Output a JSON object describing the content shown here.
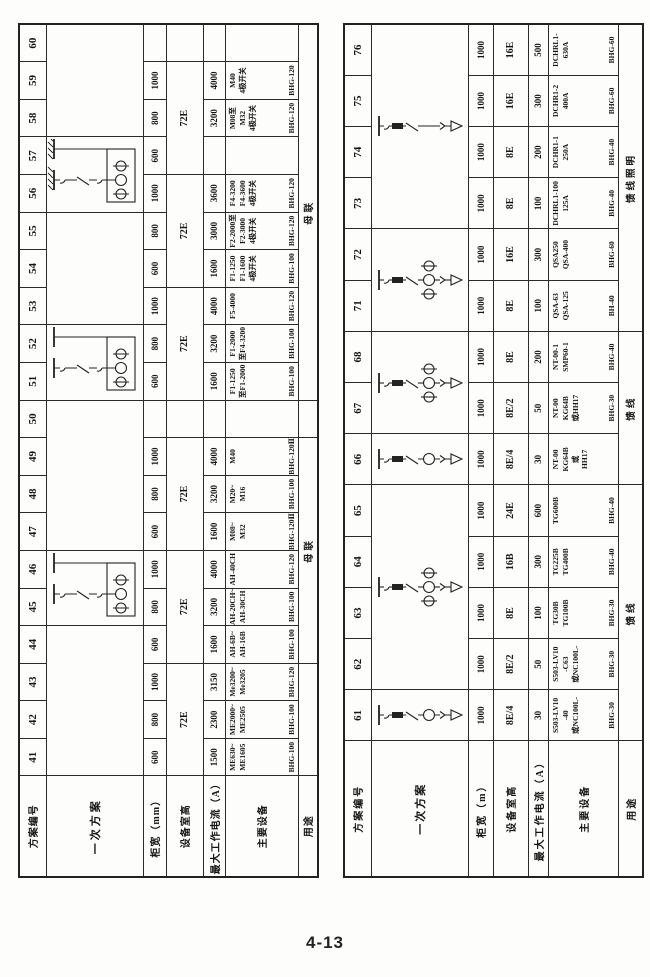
{
  "page": {
    "number": "4-13"
  },
  "left_table": {
    "header_labels": [
      "方案编号",
      "一次方案",
      "柜宽（mm）",
      "设备室高",
      "最大工作电流（A）",
      "主要设备",
      "用途"
    ],
    "column_numbers": [
      "41",
      "42",
      "43",
      "44",
      "45",
      "46",
      "47",
      "48",
      "49",
      "50",
      "51",
      "52",
      "53",
      "54",
      "55",
      "56",
      "57",
      "58",
      "59",
      "60"
    ],
    "diagram_cells": [
      {
        "span": 4,
        "type": ""
      },
      {
        "span": 2,
        "type": "bus-tie"
      },
      {
        "span": 4,
        "type": ""
      },
      {
        "span": 2,
        "type": "bus-tie"
      },
      {
        "span": 3,
        "type": ""
      },
      {
        "span": 2,
        "type": "bus-tie-earthed"
      },
      {
        "span": 3,
        "type": ""
      }
    ],
    "cabinet_width": [
      "600",
      "800",
      "1000",
      "600",
      "800",
      "1000",
      "600",
      "800",
      "1000",
      "",
      "600",
      "800",
      "1000",
      "600",
      "800",
      "1000",
      "600",
      "800",
      "1000",
      ""
    ],
    "room_height_cells": [
      {
        "span": 3,
        "text": "72E"
      },
      {
        "span": 3,
        "text": "72E"
      },
      {
        "span": 3,
        "text": "72E"
      },
      {
        "span": 1,
        "text": ""
      },
      {
        "span": 3,
        "text": "72E"
      },
      {
        "span": 3,
        "text": "72E"
      },
      {
        "span": 3,
        "text": "72E"
      },
      {
        "span": 1,
        "text": ""
      }
    ],
    "max_current": [
      "1500",
      "2300",
      "3150",
      "1600",
      "3200",
      "4000",
      "1600",
      "3200",
      "4000",
      "",
      "1600",
      "3200",
      "4000",
      "1600",
      "3000",
      "3600",
      "",
      "3200",
      "4000",
      ""
    ],
    "equipment": [
      {
        "lines": [
          "ME630~",
          "ME1605"
        ],
        "model": "BHG-100"
      },
      {
        "lines": [
          "ME2000~",
          "ME2505"
        ],
        "model": "BHG-100"
      },
      {
        "lines": [
          "Me3200~",
          "Me3205"
        ],
        "model": "BHG-120"
      },
      {
        "lines": [
          "AH-6B~",
          "AH-16B"
        ],
        "model": "BHG-100"
      },
      {
        "lines": [
          "AH-20CH~",
          "AH-30CH"
        ],
        "model": "BHG-100"
      },
      {
        "lines": [
          "AH-40CH"
        ],
        "model": "BHG-120"
      },
      {
        "lines": [
          "M08~",
          "M32"
        ],
        "model": "BHG-120Ⅱ"
      },
      {
        "lines": [
          "M20~",
          "M16"
        ],
        "model": "BHG-100"
      },
      {
        "lines": [
          "M40"
        ],
        "model": "BHG-120Ⅱ"
      },
      {
        "lines": [],
        "model": ""
      },
      {
        "lines": [
          "F1-1250",
          "至F1-2000"
        ],
        "model": "BHG-100"
      },
      {
        "lines": [
          "F1-2000",
          "至F4-3200"
        ],
        "model": "BHG-100"
      },
      {
        "lines": [
          "F5-4000"
        ],
        "model": "BHG-120"
      },
      {
        "lines": [
          "F1-1250",
          "F1-1600",
          "4极开关"
        ],
        "model": "BHG-100"
      },
      {
        "lines": [
          "F2-2000至",
          "F2-3000",
          "4极开关"
        ],
        "model": "BHG-120"
      },
      {
        "lines": [
          "F4-3200",
          "F4-3600",
          "4极开关"
        ],
        "model": "BHG-120"
      },
      {
        "lines": [],
        "model": ""
      },
      {
        "lines": [
          "M08至",
          "M32",
          "4极开关"
        ],
        "model": "BHG-120"
      },
      {
        "lines": [
          "M40",
          "4极开关"
        ],
        "model": "BHG-120"
      },
      {
        "lines": [],
        "model": ""
      }
    ],
    "usage_cells": [
      {
        "span": 3,
        "text": ""
      },
      {
        "span": 6,
        "text": "母联"
      },
      {
        "span": 1,
        "text": ""
      },
      {
        "span": 10,
        "text": "母联"
      }
    ]
  },
  "right_table": {
    "header_labels": [
      "方案编号",
      "一次方案",
      "柜宽（m）",
      "设备室高",
      "最大工作电流（A）",
      "主要设备",
      "用途"
    ],
    "column_numbers": [
      "61",
      "62",
      "63",
      "64",
      "65",
      "66",
      "67",
      "68",
      "71",
      "72",
      "73",
      "74",
      "75",
      "76"
    ],
    "diagram_cells": [
      {
        "span": 1,
        "type": "feeder-meter"
      },
      {
        "span": 4,
        "type": "feeder-cts"
      },
      {
        "span": 1,
        "type": "feeder-meter"
      },
      {
        "span": 2,
        "type": "feeder-cts"
      },
      {
        "span": 2,
        "type": "feeder-cts"
      },
      {
        "span": 4,
        "type": "feeder-plain"
      }
    ],
    "cabinet_width": [
      "1000",
      "1000",
      "1000",
      "1000",
      "1000",
      "1000",
      "1000",
      "1000",
      "1000",
      "1000",
      "1000",
      "1000",
      "1000",
      "1000"
    ],
    "room_height_cells": [
      {
        "span": 1,
        "text": "8E/4"
      },
      {
        "span": 1,
        "text": "8E/2"
      },
      {
        "span": 1,
        "text": "8E"
      },
      {
        "span": 1,
        "text": "16B"
      },
      {
        "span": 1,
        "text": "24E"
      },
      {
        "span": 1,
        "text": "8E/4"
      },
      {
        "span": 1,
        "text": "8E/2"
      },
      {
        "span": 1,
        "text": "8E"
      },
      {
        "span": 1,
        "text": "8E"
      },
      {
        "span": 1,
        "text": "16E"
      },
      {
        "span": 1,
        "text": "8E"
      },
      {
        "span": 1,
        "text": "8E"
      },
      {
        "span": 1,
        "text": "16E"
      },
      {
        "span": 1,
        "text": "16E"
      }
    ],
    "max_current": [
      "30",
      "50",
      "100",
      "300",
      "600",
      "30",
      "50",
      "200",
      "100",
      "300",
      "100",
      "200",
      "300",
      "500"
    ],
    "equipment": [
      {
        "lines": [
          "S503-LV10",
          "-40",
          "或NC100L-"
        ],
        "model": "BHG-30"
      },
      {
        "lines": [
          "S503-LV10",
          "-C63",
          "或NC100L-"
        ],
        "model": "BHG-30"
      },
      {
        "lines": [
          "TG30B",
          "TG100B"
        ],
        "model": "BHG-30"
      },
      {
        "lines": [
          "TG225B",
          "TG400B"
        ],
        "model": "BHG-40"
      },
      {
        "lines": [
          "TG600B"
        ],
        "model": "BHG-40"
      },
      {
        "lines": [
          "NT-00",
          "KG64B",
          "或",
          "HH17"
        ],
        "model": ""
      },
      {
        "lines": [
          "NT-00",
          "KG64B",
          "或HH17"
        ],
        "model": "BHG-30"
      },
      {
        "lines": [
          "NT-00-1",
          "SMP60-1"
        ],
        "model": "BHG-40"
      },
      {
        "lines": [
          "QSA-63",
          "QSA-125"
        ],
        "model": "BH-40"
      },
      {
        "lines": [
          "QSA250",
          "QSA-400"
        ],
        "model": "BHG-60"
      },
      {
        "lines": [
          "DCHRL1-100",
          "125A"
        ],
        "model": "BHG-40"
      },
      {
        "lines": [
          "DCHR1-1",
          "250A"
        ],
        "model": "BHG-40"
      },
      {
        "lines": [
          "DCHR1-2",
          "400A"
        ],
        "model": "BHG-60"
      },
      {
        "lines": [
          "DCHRL1-",
          "630A"
        ],
        "model": "BHG-60"
      }
    ],
    "usage_cells": [
      {
        "span": 5,
        "text": "馈线"
      },
      {
        "span": 3,
        "text": "馈线"
      },
      {
        "span": 6,
        "text": "馈线照明"
      }
    ]
  }
}
